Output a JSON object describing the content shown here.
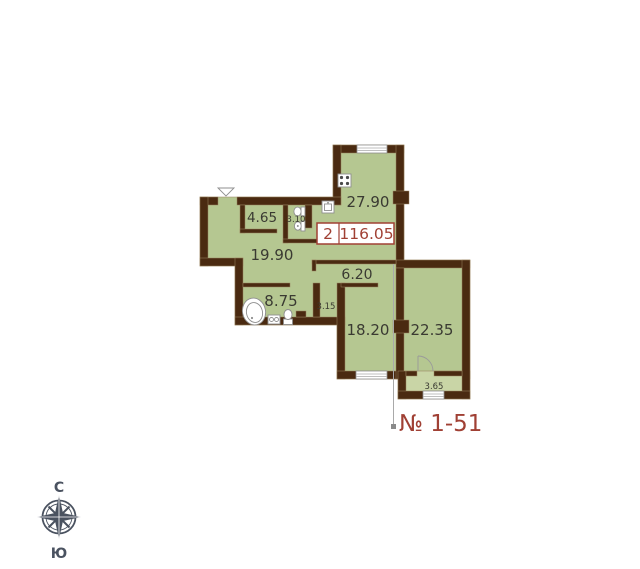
{
  "unit_box": {
    "rooms_count": "2",
    "total_area": "116.05"
  },
  "apartment_number": "№ 1-51",
  "rooms": {
    "kitchen": "27.90",
    "storage": "4.65",
    "wc": "3.10",
    "hall": "19.90",
    "corridor": "6.20",
    "bathroom": "8.75",
    "closet": "3.15",
    "bedroom": "18.20",
    "living": "22.35",
    "balcony": "3.65"
  },
  "compass": {
    "north_label": "С",
    "south_label": "Ю"
  },
  "colors": {
    "wall": "#4a2a11",
    "room_fill": "#b5c791",
    "balcony_fill": "#c9d5a6",
    "accent_red": "#a04034",
    "label_text": "#3a3a32",
    "compass": "#4a5260"
  }
}
